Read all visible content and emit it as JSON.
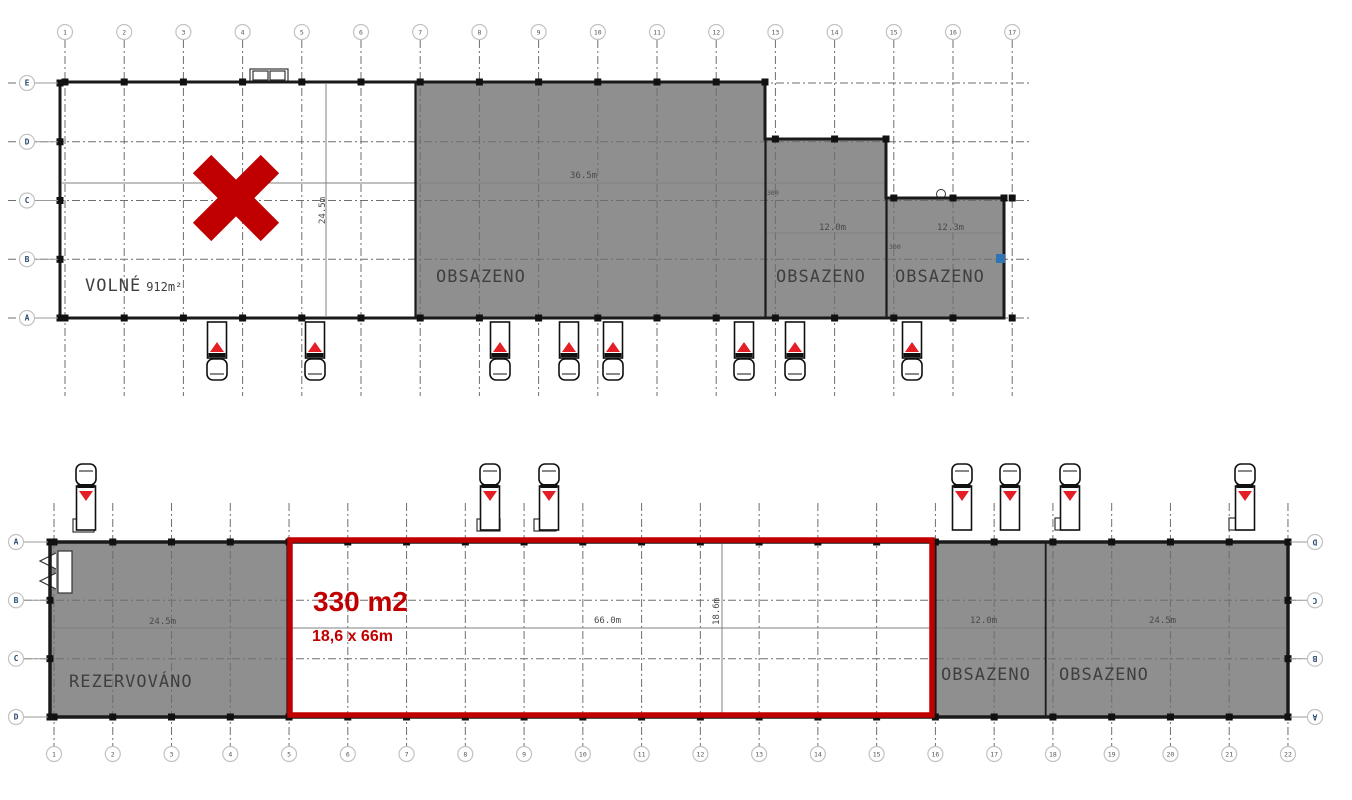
{
  "colors": {
    "occupied_fill": "#8f8f8f",
    "highlight_red": "#c00000",
    "truck_arrow_red": "#e31e24",
    "wall": "#1a1a1a",
    "axis_letter": "#2d4b73"
  },
  "top_building": {
    "columns": [
      "1",
      "2",
      "3",
      "4",
      "5",
      "6",
      "7",
      "8",
      "9",
      "10",
      "11",
      "12",
      "13",
      "14",
      "15",
      "16",
      "17"
    ],
    "rows": [
      "E",
      "D",
      "C",
      "B",
      "A"
    ],
    "units": [
      {
        "label": "VOLNÉ",
        "area": "912m²",
        "status": "available"
      },
      {
        "label": "OBSAZENO",
        "status": "occupied"
      },
      {
        "label": "OBSAZENO",
        "status": "occupied"
      },
      {
        "label": "OBSAZENO",
        "status": "occupied"
      }
    ],
    "dimensions": {
      "main_width": "36.5m",
      "hall_depth": "24.5m",
      "unit2_width": "12.0m",
      "unit3_width": "12.3m",
      "offset_a": "300",
      "offset_b": "300"
    },
    "trucks_x": [
      217,
      315,
      500,
      569,
      613,
      744,
      795,
      912
    ]
  },
  "bottom_building": {
    "columns": [
      "1",
      "2",
      "3",
      "4",
      "5",
      "6",
      "7",
      "8",
      "9",
      "10",
      "11",
      "12",
      "13",
      "14",
      "15",
      "16",
      "17",
      "18",
      "19",
      "20",
      "21",
      "22"
    ],
    "rows_left": [
      "A",
      "B",
      "C",
      "D"
    ],
    "rows_right": [
      "D",
      "C",
      "B",
      "A"
    ],
    "units": [
      {
        "label": "REZERVOVÁNO",
        "status": "reserved"
      },
      {
        "label": "330 m2",
        "sublabel": "18,6 x 66m",
        "status": "highlighted-offer"
      },
      {
        "label": "OBSAZENO",
        "status": "occupied"
      },
      {
        "label": "OBSAZENO",
        "status": "occupied"
      }
    ],
    "dimensions": {
      "reserved_width": "24.5m",
      "offer_width": "66.0m",
      "offer_depth": "18.6m",
      "unit3_width": "12.0m",
      "unit4_width": "24.5m"
    },
    "trucks_x": [
      86,
      490,
      549,
      962,
      1010,
      1070,
      1245
    ]
  }
}
